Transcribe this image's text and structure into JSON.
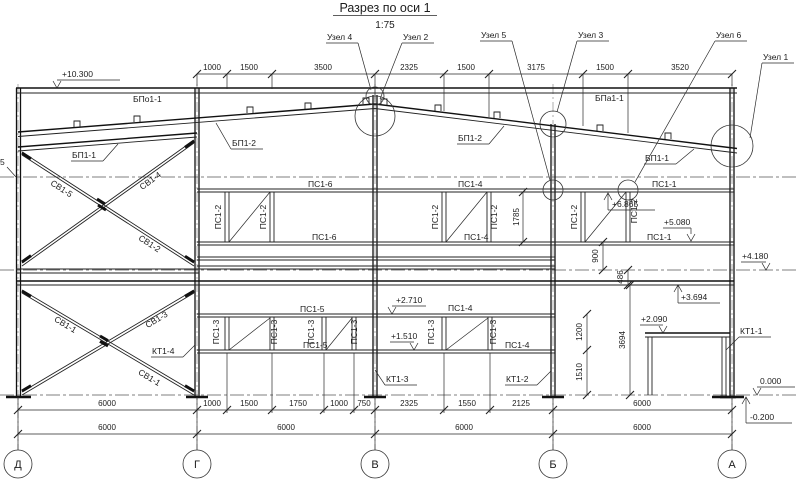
{
  "title": {
    "text": "Разрез по оси 1",
    "scale": "1:75"
  },
  "axis_labels": [
    "Д",
    "Г",
    "В",
    "Б",
    "А"
  ],
  "node_labels": {
    "n4": "Узел 4",
    "n2": "Узел 2",
    "n5": "Узел 5",
    "n3": "Узел 3",
    "n6": "Узел 6",
    "n1": "Узел 1"
  },
  "member_labels": {
    "bpo": "БПо1-1",
    "bpa": "БПа1-1",
    "bp12": "БП1-2",
    "bp11": "БП1-1",
    "ps16": "ПС1-6",
    "ps14": "ПС1-4",
    "ps11": "ПС1-1",
    "ps15": "ПС1-5",
    "ps12": "ПС1-2",
    "ps13": "ПС1-3",
    "sv15": "СВ1-5",
    "sv14": "СВ1-4",
    "sv12": "СВ1-2",
    "sv11": "СВ1-1",
    "sv13": "СВ1-3",
    "kt11": "КТ1-1",
    "kt12": "КТ1-2",
    "kt13": "КТ1-3",
    "kt14": "КТ1-4",
    "edge5": "5"
  },
  "elevations": {
    "e10300": "+10.300",
    "e6865": "+6.865",
    "e5080": "+5.080",
    "e4180": "+4.180",
    "e3694": "+3.694",
    "e2710": "+2.710",
    "e2090": "+2.090",
    "e1510": "+1.510",
    "zero": "0.000",
    "minus": "-0.200"
  },
  "dims": {
    "top": [
      "1000",
      "1500",
      "3500",
      "2325",
      "1500",
      "3175",
      "1500",
      "3520"
    ],
    "row1": [
      "6000",
      "1000",
      "1500",
      "1750",
      "1000",
      "750",
      "2325",
      "1550",
      "2125",
      "6000"
    ],
    "row2": [
      "6000",
      "6000",
      "6000",
      "6000"
    ],
    "v": {
      "d1785": "1785",
      "d900": "900",
      "d486": "486",
      "d1200": "1200",
      "d1510": "1510",
      "d3694": "3694"
    }
  }
}
